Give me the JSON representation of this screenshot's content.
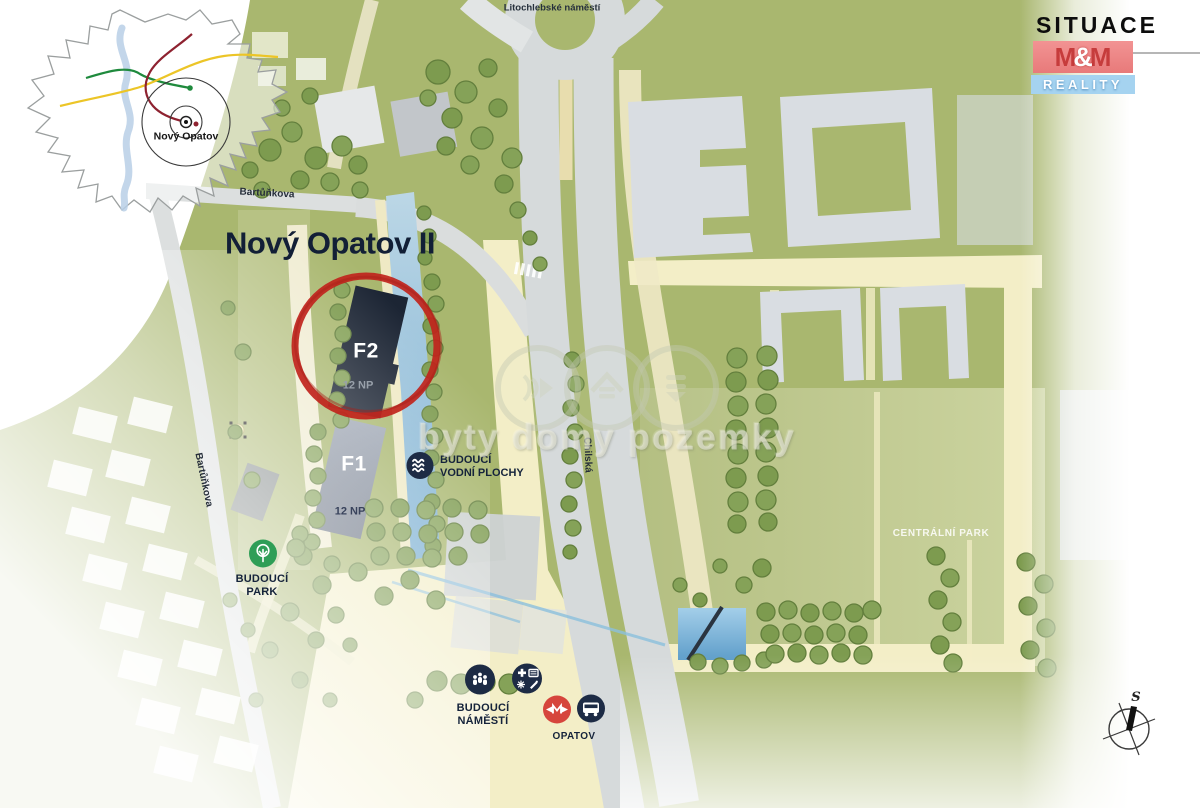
{
  "title": "Nový Opatov II",
  "inset": {
    "place_label": "Nový Opatov"
  },
  "logo": {
    "line1": "SITUACE",
    "m_left": "M",
    "ampersand": "&",
    "m_right": "M",
    "line2": "REALITY"
  },
  "streets": {
    "litochlebske": "Litochlebské náměstí",
    "bartunkova_top": "Bartůňkova",
    "bartunkova_west": "Bartůňkova",
    "chilska": "Chilská"
  },
  "areas": {
    "centralni_park": "CENTRÁLNÍ PARK"
  },
  "buildings": {
    "f2": {
      "name": "F2",
      "floors": "12 NP"
    },
    "f1": {
      "name": "F1",
      "floors": "12 NP"
    }
  },
  "poi": {
    "budouci_park": {
      "line1": "BUDOUCÍ",
      "line2": "PARK"
    },
    "budouci_vodni_plochy": {
      "line1": "BUDOUCÍ",
      "line2": "VODNÍ PLOCHY"
    },
    "budouci_namesti": {
      "line1": "BUDOUCÍ",
      "line2": "NÁMĚSTÍ"
    },
    "opatov": {
      "label": "OPATOV"
    }
  },
  "watermark": "byty domy pozemky",
  "compass": {
    "north_label": "S"
  },
  "colors": {
    "map_green": "#a9b76f",
    "park_green": "#b9c488",
    "path_cream": "#f3eec7",
    "road_gray": "#d6dadb",
    "building_gray": "#d9dde2",
    "f2_navy": "#1c2534",
    "f1_slate": "#7e8796",
    "water_blue": "#8fbcd9",
    "highlight_red": "#c0241c",
    "metro_red": "#d6453c",
    "icon_navy": "#1d2b45",
    "park_icon_green": "#2f9e57",
    "logo_red": "#ef8585",
    "logo_blue": "#a5d3f0"
  }
}
